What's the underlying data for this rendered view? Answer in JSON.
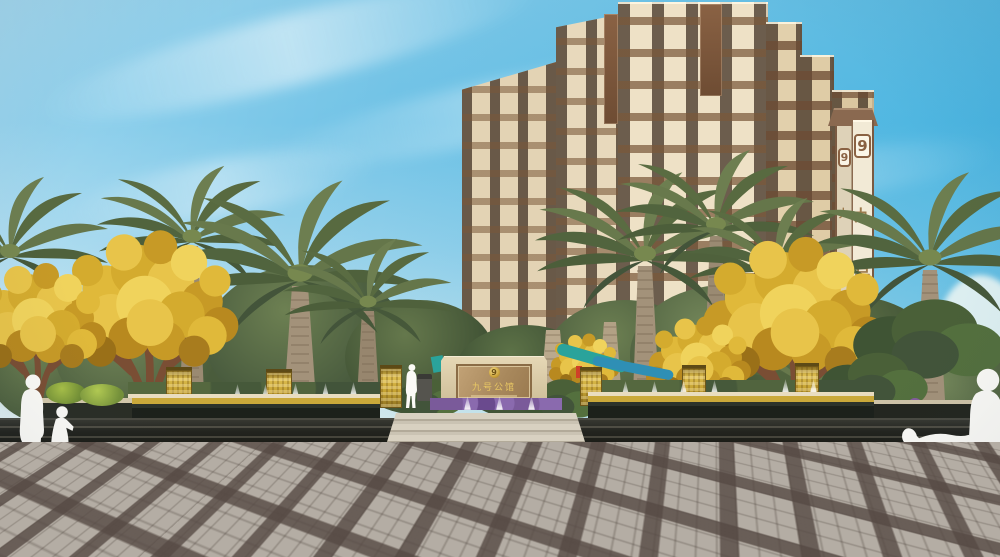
{
  "project": {
    "name": "九号公馆",
    "logo_glyph": "9"
  },
  "tower_sign": {
    "front": {
      "logo": "9",
      "chars": [
        "九",
        "号",
        "公",
        "馆"
      ]
    },
    "side": {
      "logo": "9",
      "chars": [
        "九",
        "号",
        "公"
      ]
    }
  },
  "monument_sign": {
    "logo": "9",
    "name": "九号公馆"
  },
  "palette": {
    "sky_cyan": "#2fb4e2",
    "sky_pale": "#dfeef0",
    "facade_cream": "#ecdfc4",
    "balcony_brown": "#7a5a3e",
    "sign_brown": "#8a6a50",
    "gold_accent": "#c9a93a",
    "foliage_green": "#5d7247",
    "foliage_gold": "#d9b32e",
    "stone_dark": "#23261f",
    "paving_light": "#b4ada4",
    "paving_band": "#796e66"
  }
}
